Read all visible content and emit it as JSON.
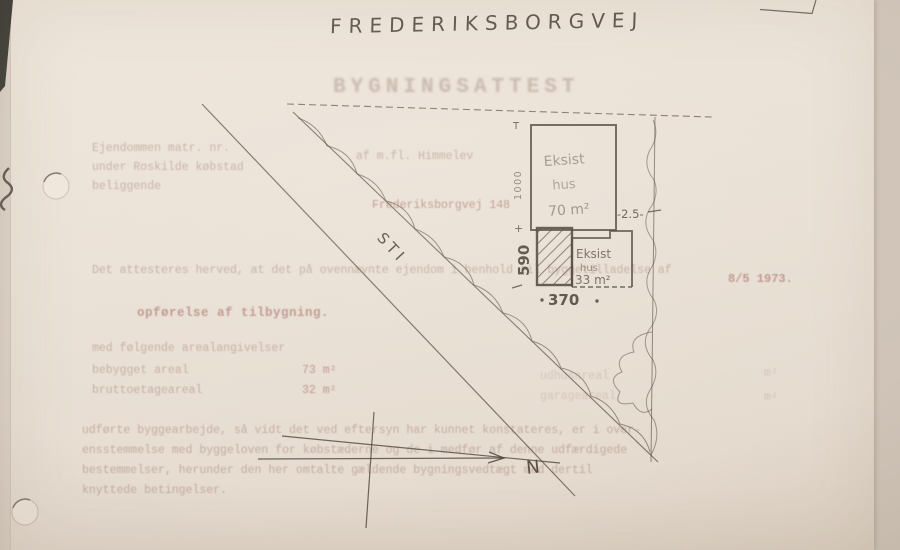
{
  "colors": {
    "paper": "#eae1d6",
    "ink": "#4f4439",
    "faint_type": "#a3786d",
    "photo_edge": "#cfc4b7"
  },
  "header": {
    "street_name": "FREDERIKSBORGVEJ",
    "title": "BYGNINGSATTEST"
  },
  "typed": {
    "intro_left": [
      "Ejendommen matr. nr.",
      "under Roskilde købstad",
      "beliggende"
    ],
    "intro_right_line1": "af m.fl. Himmelev",
    "intro_right_line2": "Frederiksborgvej 148",
    "attest_line": "Det attesteres herved, at det på ovennævnte ejendom i henhold til byggetilladelse af",
    "attest_date": "8/5 1973.",
    "work_heading": "opførelse af tilbygning.",
    "areas_intro": "med følgende arealangivelser",
    "area_rows": [
      {
        "label": "bebygget areal",
        "value": "73 m²"
      },
      {
        "label": "bruttoetageareal",
        "value": "32 m²"
      }
    ],
    "area_rows_right": [
      {
        "label": "udhusareal",
        "unit": "m²"
      },
      {
        "label": "garageareal",
        "unit": "m²"
      }
    ],
    "closing_lines": [
      "udførte byggearbejde, så vidt det ved eftersyn har kunnet konstateres, er i over-",
      "ensstemmelse med byggeloven for købstæderne og de i medfør af denne udfærdigede",
      "bestemmelser, herunder den her omtalte gældende bygningsvedtægt med dertil",
      "knyttede betingelser."
    ]
  },
  "plan": {
    "path_label": "STI",
    "north_label": "N",
    "house70_lines": [
      "Eksist",
      "hus",
      "70 m²"
    ],
    "house33_lines": [
      "Eksist",
      "hus",
      "33 m²"
    ],
    "dims": {
      "left_height": "1000",
      "addition_height": "590",
      "addition_width": "370",
      "east_gap": "-2.5-",
      "top_tick": "T",
      "plus_mark": "+"
    }
  }
}
